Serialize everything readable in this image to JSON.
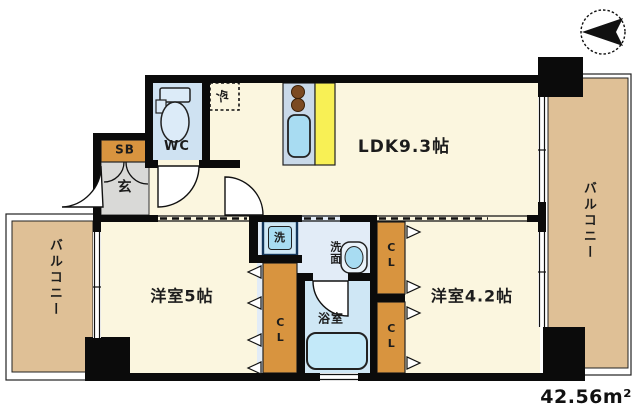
{
  "plan": {
    "area_label": "42.56m²",
    "rooms": {
      "ldk": "LDK9.3帖",
      "west5": "洋室5帖",
      "west42": "洋室4.2帖",
      "balcony_left": "バルコニー",
      "balcony_right": "バルコニー"
    },
    "spaces": {
      "wc": "WC",
      "shoe_box": "SB",
      "entrance": "玄",
      "washroom": "洗面",
      "bath": "浴室"
    },
    "fixtures": {
      "refrigerator": "冷",
      "washer": "洗"
    },
    "closets": {
      "cl_west5": "CL",
      "cl_west42_top": "CL",
      "cl_west42_bottom": "CL"
    },
    "colors": {
      "wall": "#0b0b0b",
      "room_cream": "#fbf6df",
      "balcony_tan": "#dfc096",
      "closet_orange": "#d8943f",
      "genkan_gray": "#d9d9d7",
      "water_blue": "#cfe2f2",
      "wet_pale": "#e2ecf7",
      "bath_blue": "#cfe7f5",
      "tub_blue": "#c3e9f9",
      "kitchen_yellow": "#f8f055",
      "counter_blue": "#c9d9e9",
      "fixture_blue": "#a8dcf2"
    }
  }
}
